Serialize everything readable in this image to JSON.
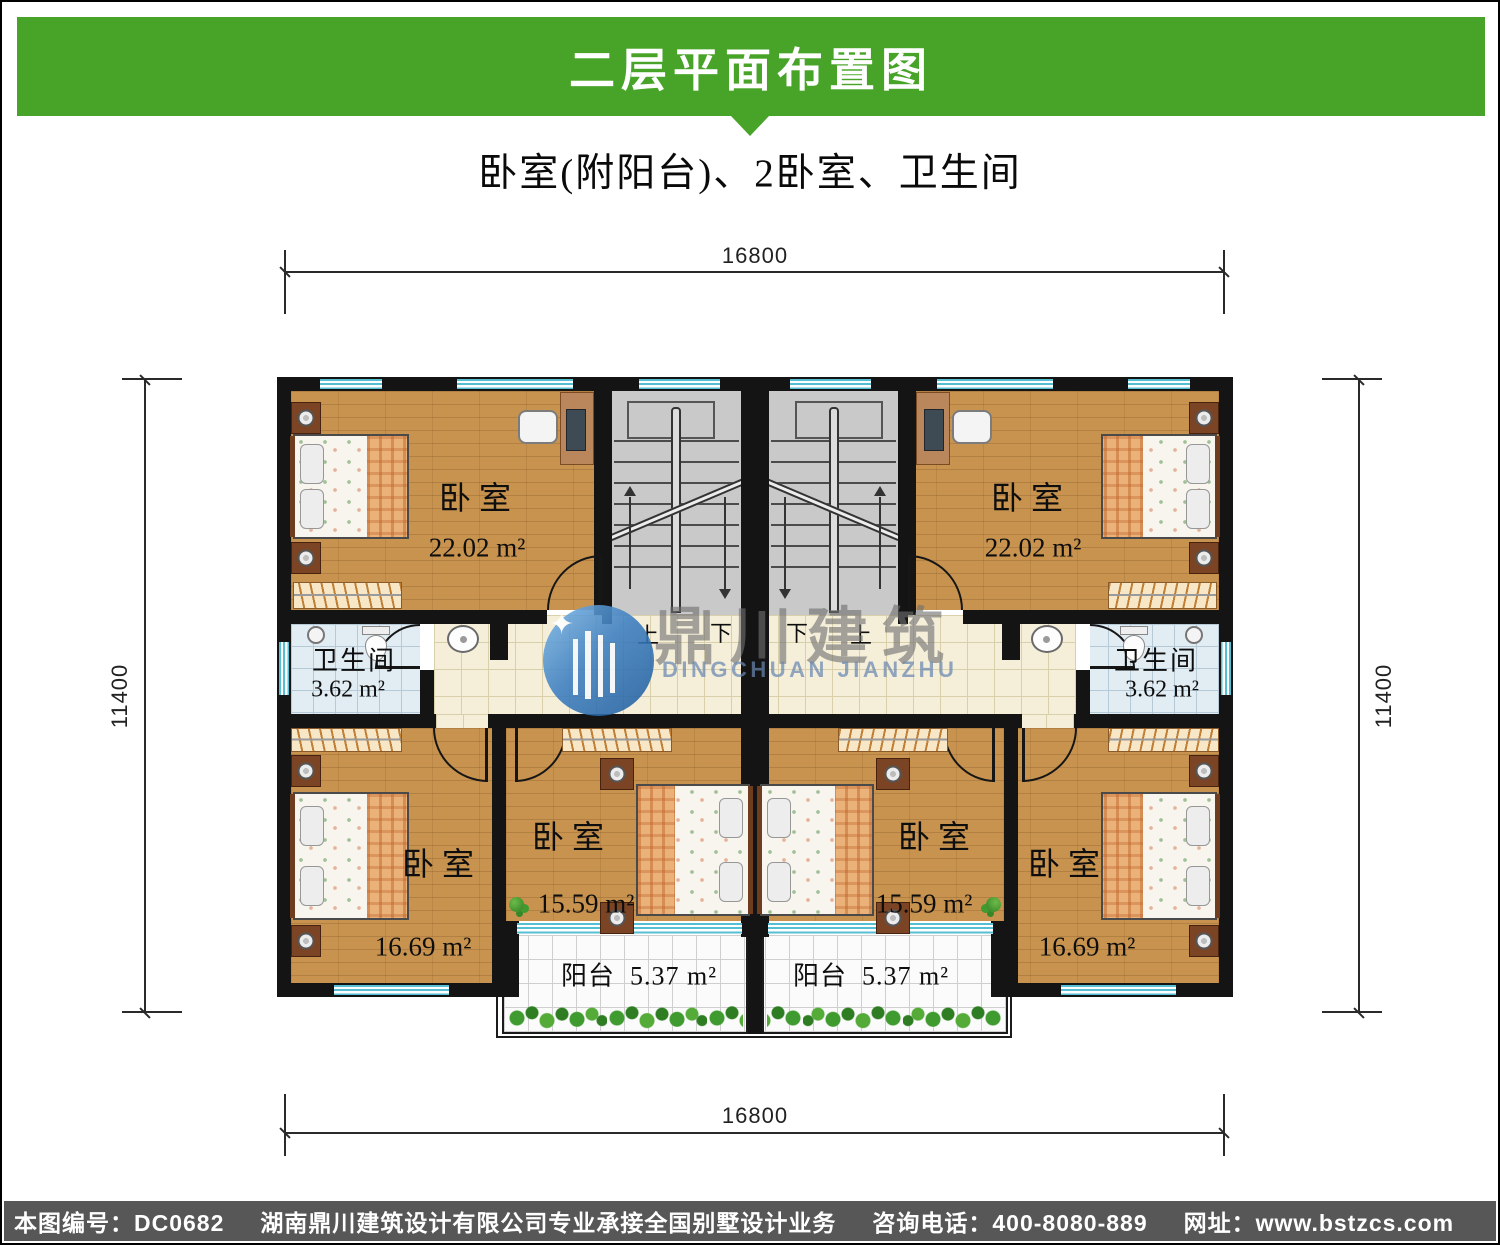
{
  "header": {
    "title": "二层平面布置图",
    "subtitle": "卧室(附阳台)、2卧室、卫生间",
    "banner_color": "#48a428"
  },
  "dims": {
    "top": "16800",
    "bottom": "16800",
    "left": "11400",
    "right": "11400"
  },
  "stair_labels": {
    "l_up": "上",
    "l_down": "下",
    "r_down": "下",
    "r_up": "上"
  },
  "rooms": {
    "bedroom_tl": {
      "name": "卧室",
      "area": "22.02 m²"
    },
    "bedroom_tr": {
      "name": "卧室",
      "area": "22.02 m²"
    },
    "bath_l": {
      "name": "卫生间",
      "area": "3.62 m²"
    },
    "bath_r": {
      "name": "卫生间",
      "area": "3.62 m²"
    },
    "bedroom_bl": {
      "name": "卧室",
      "area": "16.69 m²"
    },
    "bedroom_blc": {
      "name": "卧室",
      "area": "15.59 m²"
    },
    "bedroom_brc": {
      "name": "卧室",
      "area": "15.59 m²"
    },
    "bedroom_br": {
      "name": "卧室",
      "area": "16.69 m²"
    },
    "balcony_l": {
      "name": "阳台",
      "area": "5.37 m²"
    },
    "balcony_r": {
      "name": "阳台",
      "area": "5.37 m²"
    }
  },
  "watermark": {
    "cn": "鼎川建筑",
    "en": "DINGCHUAN JIANZHU"
  },
  "footer": {
    "plan_no": "本图编号：DC0682",
    "company": "湖南鼎川建筑设计有限公司专业承接全国别墅设计业务",
    "phone": "咨询电话：400-8080-889",
    "website": "网址：www.bstzcs.com"
  }
}
